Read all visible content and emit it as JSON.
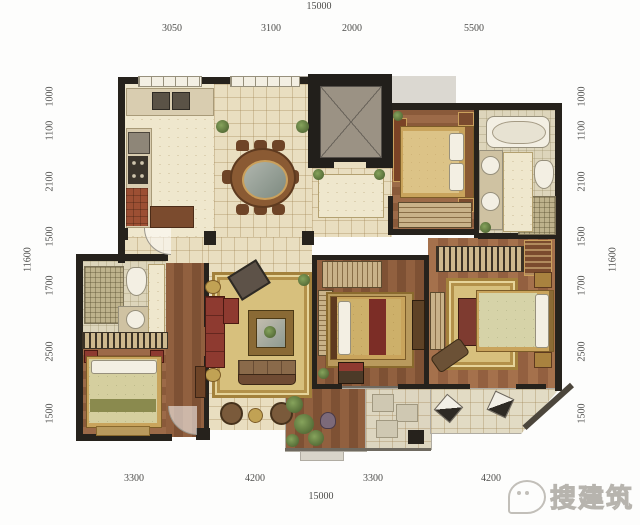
{
  "dims": {
    "top_total": "15000",
    "top_segments": [
      "3050",
      "3100",
      "2000",
      "5500"
    ],
    "bottom_segments": [
      "3300",
      "4200",
      "3300",
      "4200"
    ],
    "bottom_total": "15000",
    "left_total": "11600",
    "left_segments": [
      "1000",
      "1100",
      "2100",
      "1500",
      "1700",
      "2500",
      "1500"
    ],
    "right_total": "11600",
    "right_segments": [
      "1000",
      "1100",
      "2100",
      "1500",
      "1700",
      "2500",
      "1500"
    ]
  },
  "watermark": {
    "brand": "搜建筑"
  },
  "colors": {
    "wall": "#26221c",
    "tile_floor": "#e9dec0",
    "wood_floor": "#91603f",
    "rug_gold": "#d7c07d",
    "sofa_red": "#8e3a30",
    "bed_gold": "#d3b878",
    "bed_cream": "#d6d3a8",
    "plant_green": "#5e7a3f",
    "fixture_white": "#f3efe3"
  }
}
